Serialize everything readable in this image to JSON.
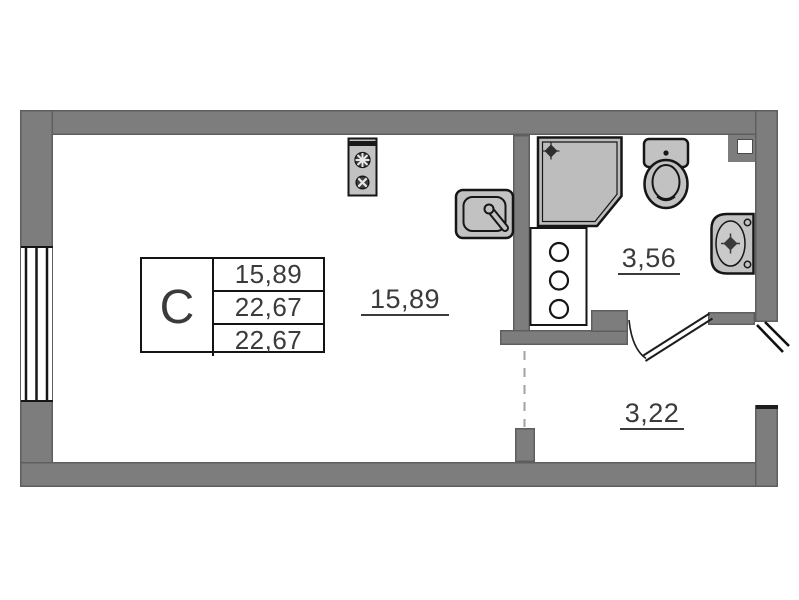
{
  "title": "Studio apartment floor plan",
  "colors": {
    "wall": "#7d7d7d",
    "wallEdge": "#555555",
    "fixtureFill": "#c2c2c2",
    "fixtureStroke": "#161616",
    "showerFill": "#bdbdbd",
    "text": "#3b3b3b",
    "dash": "#a2a2a2",
    "background": "#ffffff"
  },
  "stamp": {
    "type_label": "С",
    "rows": [
      "15,89",
      "22,67",
      "22,67"
    ]
  },
  "rooms": {
    "living": {
      "area": "15,89"
    },
    "bathroom": {
      "area": "3,56"
    },
    "hallway": {
      "area": "3,22"
    }
  },
  "fixtures": {
    "stove": "two-burner-stove",
    "kitchen_sink": "kitchen-sink",
    "shower": "corner-shower-cabin",
    "washer": "washing-column",
    "toilet": "toilet-with-tank",
    "basin": "wall-hung-basin",
    "window": "triple-line-window",
    "bathroom_door": "swing-door",
    "entrance_door": "entrance-door-leaf"
  }
}
